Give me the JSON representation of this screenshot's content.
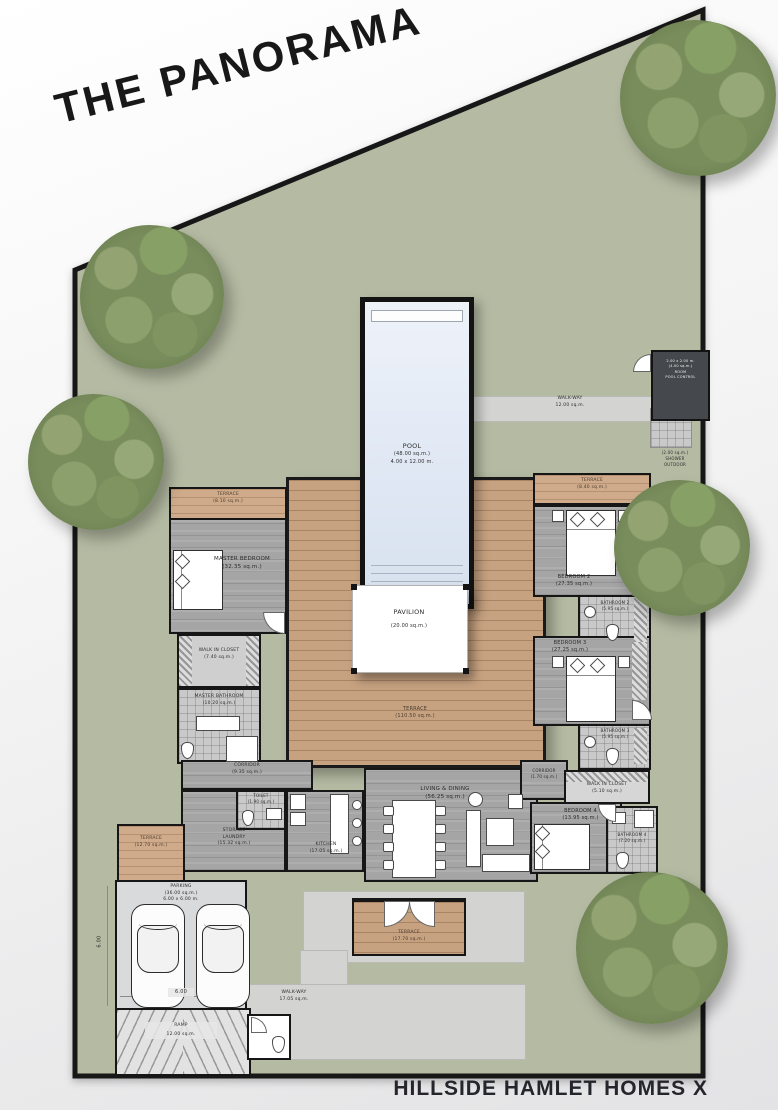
{
  "title": "THE PANORAMA",
  "footer": "HILLSIDE HAMLET HOMES X",
  "colors": {
    "site_green": "#b5bba3",
    "walkway_gray": "#d3d4d2",
    "deck_wood": "#c7a281",
    "interior_floor": "#a5a5a5",
    "wall_black": "#161616",
    "pool_water": "#e0e8f4",
    "tree_green": "#788c5c",
    "pool_control_dark": "#45494d"
  },
  "rooms": {
    "pool": {
      "name": "POOL",
      "area": "(48.00 sq.m.)",
      "dims": "4.00 x 12.00 m."
    },
    "pavilion": {
      "name": "PAVILION",
      "area": "(20.00 sq.m.)"
    },
    "terrace_main": {
      "name": "TERRACE",
      "area": "(110.50 sq.m.)"
    },
    "terrace_master": {
      "name": "TERRACE",
      "area": "(8.10 sq.m.)"
    },
    "master_bedroom": {
      "name": "MASTER BEDROOM",
      "area": "(32.35 sq.m.)"
    },
    "wic_master": {
      "name": "WALK IN CLOSET",
      "area": "(7.40 sq.m.)"
    },
    "master_bath": {
      "name": "MASTER BATHROOM",
      "area": "(10.20 sq.m.)"
    },
    "corridor_left": {
      "name": "CORRIDOR",
      "area": "(9.35 sq.m.)"
    },
    "toilet": {
      "name": "TOILET",
      "area": "(1.90 sq.m.)"
    },
    "storage_laundry": {
      "name1": "STORAGE",
      "name2": "LAUNDRY",
      "area": "(15.32 sq.m.)"
    },
    "kitchen": {
      "name": "KITCHEN",
      "area": "(17.05 sq.m.)"
    },
    "living_dining": {
      "name": "LIVING & DINING",
      "area": "(56.25 sq.m.)"
    },
    "corridor_right": {
      "name": "CORRIDOR",
      "area": "(1.70 sq.m.)"
    },
    "wic4": {
      "name": "WALK IN CLOSET",
      "area": "(5.10 sq.m.)"
    },
    "bedroom4": {
      "name": "BEDROOM 4",
      "area": "(13.95 sq.m.)"
    },
    "bathroom4": {
      "name": "BATHROOM 4",
      "area": "(7.20 sq.m.)"
    },
    "terrace_right": {
      "name": "TERRACE",
      "area": "(8.40 sq.m.)"
    },
    "bedroom2": {
      "name": "BEDROOM 2",
      "area": "(27.35 sq.m.)"
    },
    "bathroom2": {
      "name": "BATHROOM 2",
      "area": "(5.95 sq.m.)"
    },
    "bedroom3": {
      "name": "BEDROOM 3",
      "area": "(27.25 sq.m.)"
    },
    "bathroom3": {
      "name": "BATHROOM 3",
      "area": "(5.95 sq.m.)"
    },
    "terrace_bottom": {
      "name": "TERRACE",
      "area": "(17.70 sq.m.)"
    },
    "terrace_left": {
      "name": "TERRACE",
      "area": "(12.70 sq.m.)"
    },
    "parking": {
      "name": "PARKING",
      "area": "(36.00 sq.m.)",
      "dims": "6.00 x 6.00 m."
    },
    "ramp": {
      "name": "RAMP",
      "area": "12.00 sq.m."
    },
    "walkway_top": {
      "name": "WALK-WAY",
      "area": "12.00 sq.m."
    },
    "walkway_bottom": {
      "name": "WALK-WAY",
      "area": "17.05 sq.m."
    },
    "pool_control": {
      "l1": "2.00 x 2.00 m.",
      "l2": "(4.00 sq.m.)",
      "l3": "ROOM",
      "l4": "POOL CONTROL"
    },
    "shower_outdoor": {
      "l1": "(2.00 sq.m.)",
      "l2": "SHOWER",
      "l3": "OUTDOOR"
    }
  },
  "dimensions": {
    "parking_w": "6.00",
    "parking_h": "6.00"
  }
}
